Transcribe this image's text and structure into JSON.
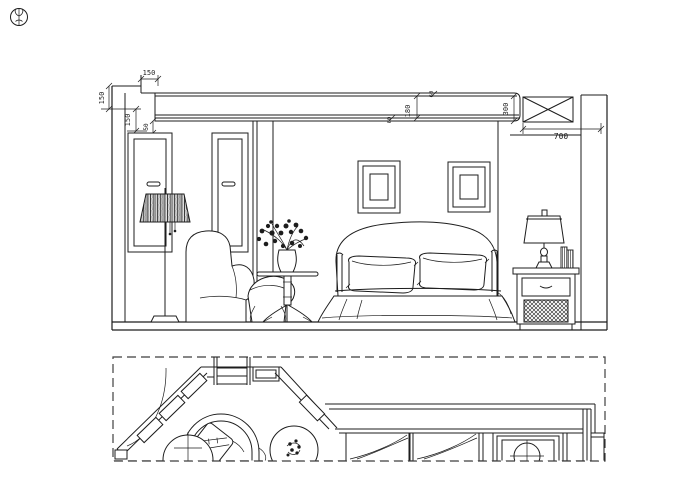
{
  "colors": {
    "line": "#1d1d1d",
    "background": "#ffffff",
    "dashed_border": "#3f3f3f"
  },
  "icons": {
    "title_symbol": "plant-monogram"
  },
  "elevation": {
    "dimensions": {
      "top_offset": "150",
      "left_upper": "150",
      "left_lower": "150",
      "left_small": "50",
      "beam_top_small": "60",
      "beam_fascia": "180",
      "beam_bottom_small": "60",
      "beam_total_height": "300",
      "top_cabinet_width": "700"
    }
  }
}
